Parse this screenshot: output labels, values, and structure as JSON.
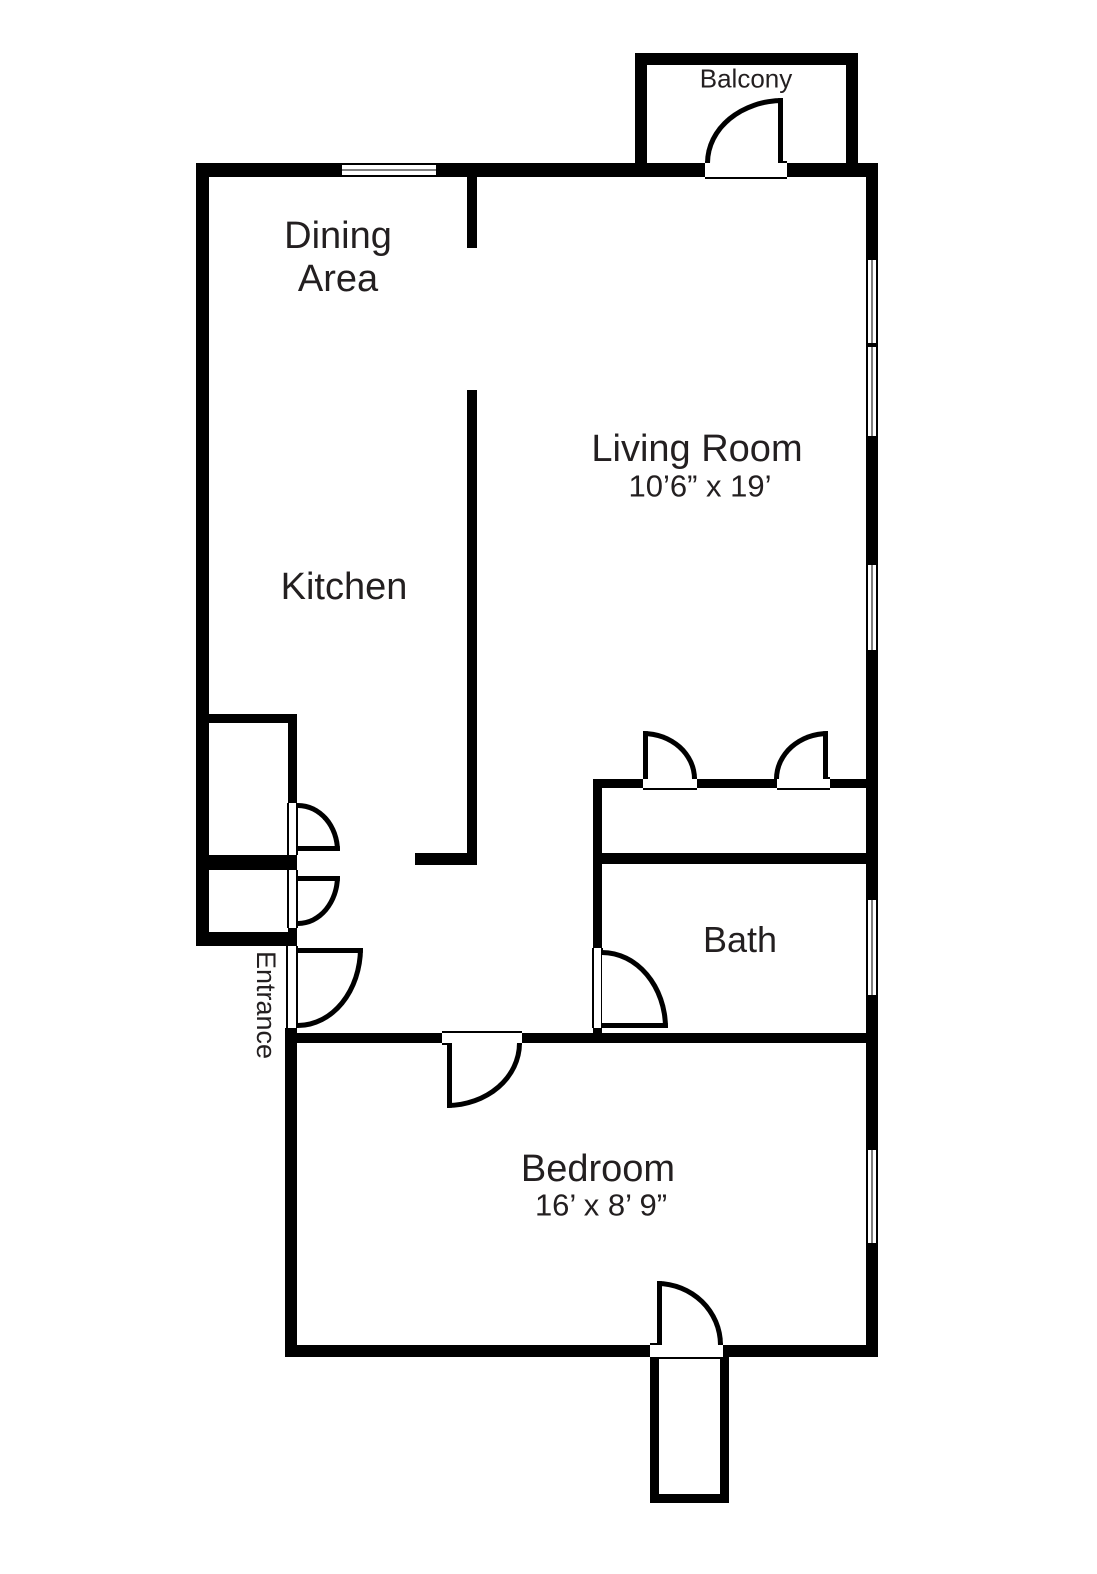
{
  "floorplan": {
    "background_color": "#ffffff",
    "wall_color": "#000000",
    "text_color": "#231f20",
    "labels": {
      "balcony": "Balcony",
      "dining_line1": "Dining",
      "dining_line2": "Area",
      "living_room": "Living Room",
      "living_room_dimensions": "10’6” x 19’",
      "kitchen": "Kitchen",
      "bath": "Bath",
      "entrance": "Entrance",
      "bedroom": "Bedroom",
      "bedroom_dimensions": "16’ x 8’ 9”"
    }
  }
}
